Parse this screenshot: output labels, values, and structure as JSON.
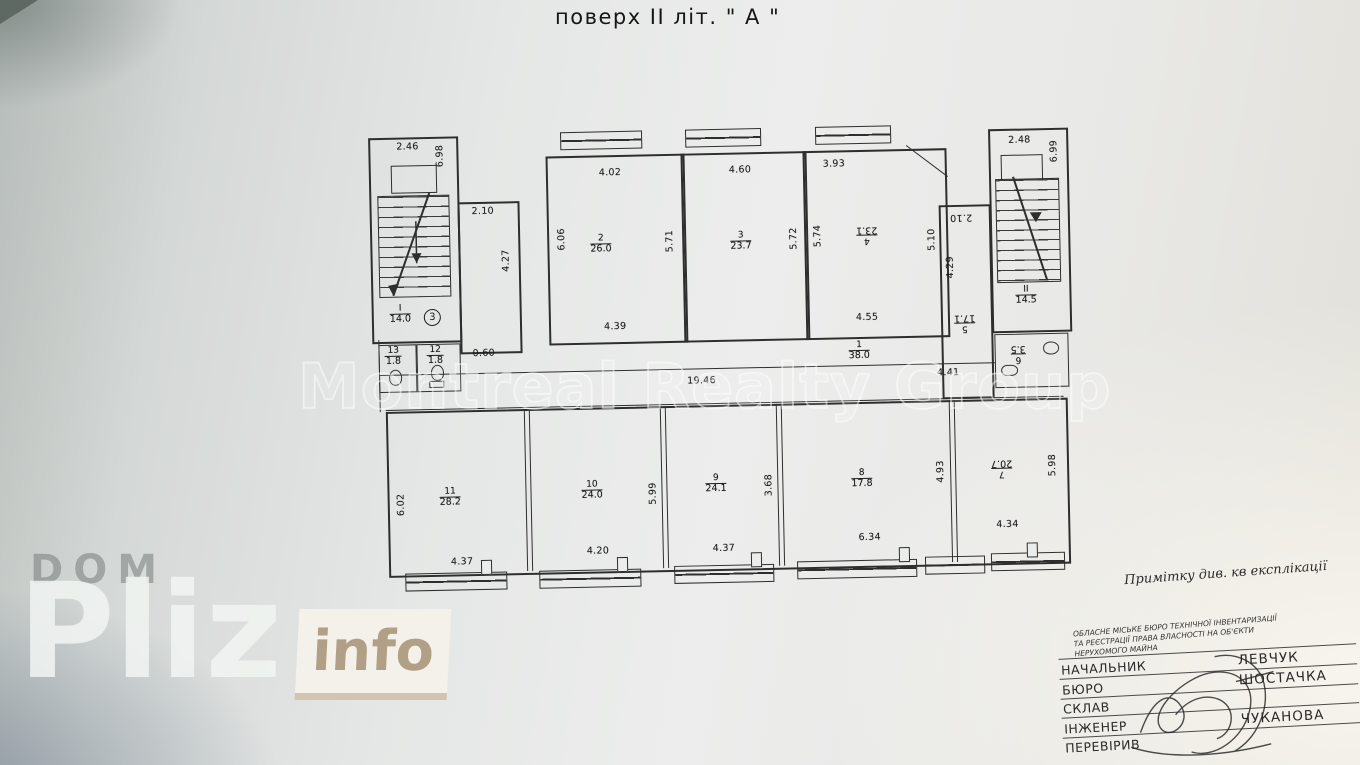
{
  "title": "поверх II літ. \" А \"",
  "note": "Примітку див. кв експлікації",
  "watermarks": {
    "center": "Montreal Realty Group",
    "dom": "DOM",
    "pliz": "Pliz",
    "info": "info"
  },
  "stamp": {
    "header_line1": "ОБЛАСНЕ МІСЬКЕ БЮРО ТЕХНІЧНОЇ ІНВЕНТАРИЗАЦІЇ",
    "header_line2": "ТА РЕЄСТРАЦІЇ ПРАВА ВЛАСНОСТІ НА ОБ'ЄКТИ",
    "header_line3": "НЕРУХОМОГО МАЙНА",
    "rows": [
      {
        "label": "НАЧАЛЬНИК",
        "name": "ЛЕВЧУК"
      },
      {
        "label": "БЮРО",
        "name": "ШОСТАЧКА"
      },
      {
        "label": "СКЛАВ",
        "name": ""
      },
      {
        "label": "ІНЖЕНЕР",
        "name": "ЧУКАНОВА"
      },
      {
        "label": "ПЕРЕВІРИВ",
        "name": ""
      }
    ]
  },
  "plan": {
    "stair_left": {
      "number": "I",
      "area": "14.0",
      "badge": "3",
      "dim_top": "2.46",
      "dim_side": "6.98"
    },
    "vestibule": {
      "dim_top": "2.10",
      "dim_side": "4.27"
    },
    "room2": {
      "number": "2",
      "area": "26.0",
      "dim_top": "4.02",
      "dim_left": "6.06",
      "dim_right": "5.71",
      "dim_bottom": "4.39"
    },
    "room3": {
      "number": "3",
      "area": "23.7",
      "dim_top": "4.60",
      "dim_right": "5.72"
    },
    "room4": {
      "number": "4",
      "area": "23.1",
      "dim_top": "3.93",
      "dim_left": "5.74",
      "dim_right": "5.10",
      "dim_bottom": "4.55"
    },
    "room5": {
      "number": "5",
      "area": "17.1",
      "dim_top": "2.10",
      "dim_side": "4.29"
    },
    "stair_right": {
      "number": "II",
      "area": "14.5",
      "dim_top": "2.48",
      "dim_side": "6.99"
    },
    "wc6": {
      "number": "6",
      "area": "3.5"
    },
    "wc13": {
      "number": "13",
      "area": "1.8"
    },
    "wc12": {
      "number": "12",
      "area": "1.8"
    },
    "wc_dim": "0.60",
    "corridor": {
      "number": "1",
      "area": "38.0",
      "dim_left": "19.46",
      "dim_right": "4.41"
    },
    "room11": {
      "number": "11",
      "area": "28.2",
      "dim_left": "6.02",
      "dim_bottom": "4.37"
    },
    "room10": {
      "number": "10",
      "area": "24.0",
      "dim_bottom": "4.20",
      "dim_right": "5.99"
    },
    "room9": {
      "number": "9",
      "area": "24.1",
      "dim_bottom": "4.37",
      "dim_right": "3.68"
    },
    "room8": {
      "number": "8",
      "area": "17.8",
      "dim_bottom": "6.34",
      "dim_right": "4.93"
    },
    "room7": {
      "number": "7",
      "area": "20.7",
      "dim_bottom": "4.34",
      "dim_right": "5.98"
    }
  }
}
